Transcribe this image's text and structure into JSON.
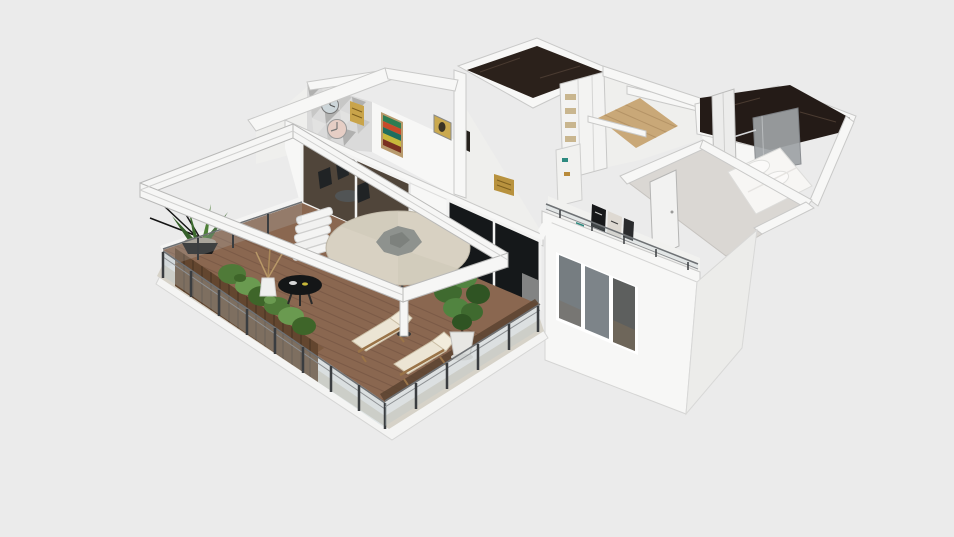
{
  "scene": {
    "description": "3D dollhouse-style overhead render of an apartment floor plan with a large wrap-around wooden terrace, white cut-away walls, pergola frame and furnished rooms",
    "view": "isometric overhead render",
    "background_color": "#ebebeb"
  },
  "rooms": [
    {
      "id": "terrace",
      "label": "wood deck terrace"
    },
    {
      "id": "living-room",
      "label": "living room behind sliding glass doors"
    },
    {
      "id": "home-office",
      "label": "home office with mosaic accent wall"
    },
    {
      "id": "bathroom-1",
      "label": "dark marble bathroom"
    },
    {
      "id": "wardrobe-hall",
      "label": "wardrobe hallway"
    },
    {
      "id": "bathroom-2",
      "label": "dark marble bathroom with shower"
    },
    {
      "id": "bedroom",
      "label": "bedroom with double bed"
    },
    {
      "id": "front-room",
      "label": "front room with large window"
    }
  ],
  "objects": [
    "pergola-frame",
    "patio-umbrella",
    "umbrella-pole",
    "round-coffee-table",
    "branch-vase",
    "white-steps",
    "lounge-chair",
    "lounge-chair",
    "planter-crates",
    "shrub-row",
    "potted-plant-bowl",
    "potted-tree",
    "glass-railing",
    "stone-border",
    "sliding-glass-doors",
    "wall-clock",
    "wall-clock",
    "chevron-artwork",
    "gold-artwork",
    "wardrobe",
    "floating-shelf",
    "shower-enclosure",
    "double-bed",
    "bedroom-door",
    "closet-sliding-door",
    "window",
    "poster-art",
    "roof-railing"
  ],
  "palette": {
    "bg": "#ebebeb",
    "wall": "#f7f7f6",
    "wallDim": "#efefed",
    "wallShade": "#ececea",
    "band": "#c9c9c8",
    "glassDark": "#20262a",
    "glassDarker": "#15181a",
    "interiorWood": "#8a6a4e",
    "deck": "#8a6750",
    "deckLine": "#6f5140",
    "deckDark": "#5a4330",
    "crate": "#63462f",
    "cratePlank": "#3f2c1e",
    "crateTop": "#7d5b41",
    "stone": "#d6d2c8",
    "baseWhite": "#f4f4f3",
    "shrub": "#4f7a38",
    "shrubDark": "#3e6529",
    "shrubLight": "#6a9a50",
    "foliage": "#3f6a2f",
    "foliageDark": "#2f5423",
    "trunk": "#4a3626",
    "potWhite": "#e8e7e4",
    "umbrella": "#d8d1c2",
    "umbrellaEdge": "#bdb6a6",
    "leafGray": "#8e928e",
    "pole": "#4a4a4a",
    "marble1": "#2b211b",
    "marble2": "#241b17",
    "marbleStreak": "#4a3b31",
    "shower": "#9fa3a6",
    "woodFloor": "#c9a878",
    "woodFloorLine": "#ab8a5e",
    "bedroomFloor": "#dad7d3",
    "windowGlass": "#767d81",
    "windowGlassWarm": "#7a6a58",
    "railMetal": "#3a3d40",
    "railGlass": "#b9c6ca",
    "railLine": "#6e7174",
    "cushion": "#ece5d4",
    "cushionEdge": "#cbbfa6",
    "chairWood": "#9a7448",
    "black": "#141617",
    "gold": "#b8923e",
    "goldDark": "#7d5f1e",
    "artGreen": "#2e7d52",
    "artRed": "#c84a2a",
    "artTeal": "#1f6e5e",
    "artYellow": "#c8b83a",
    "artBrown": "#7a3020",
    "clockBlue": "#cdd6da",
    "clockPink": "#e6cec5",
    "triA": "#c7c7c6",
    "triB": "#b0b0af",
    "triC": "#e2e2e1",
    "curtain": "#dcdcda",
    "posterDark": "#17181a",
    "posterLight": "#ded9d2",
    "teal": "#2e8a80"
  }
}
